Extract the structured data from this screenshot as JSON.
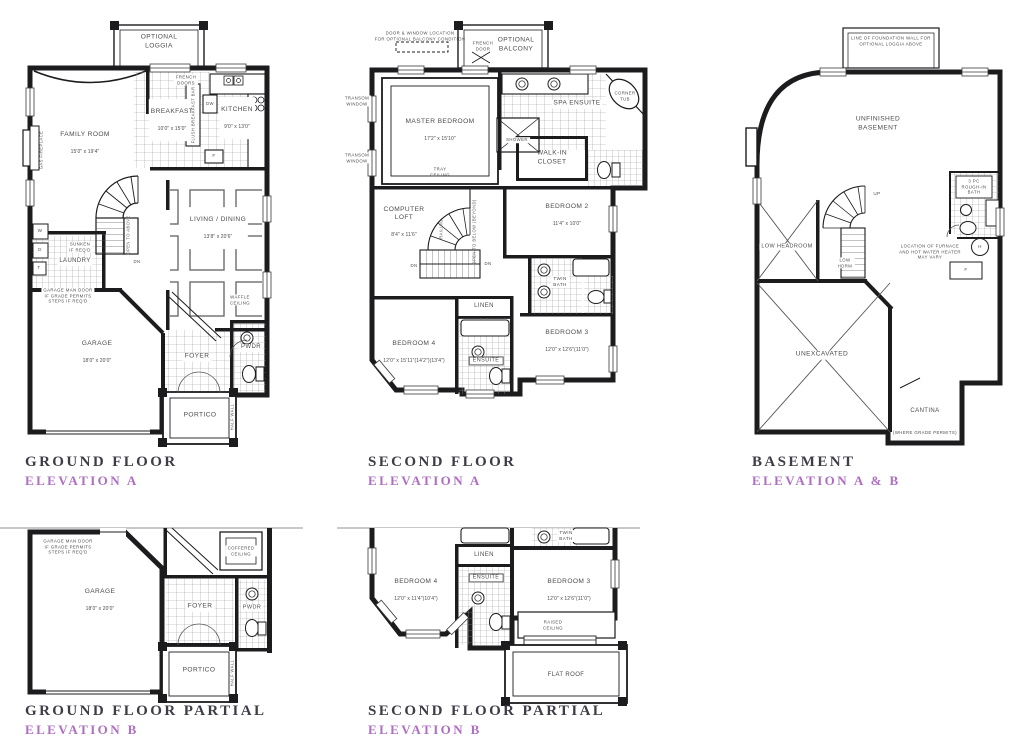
{
  "meta": {
    "sheet_background": "#ffffff",
    "wall_ink": "#1c1c1f",
    "label_gray": "#4c4c4e",
    "title_gray": "#3d3d47",
    "accent_purple": "#ae6fc3"
  },
  "ground_floor": {
    "title": "GROUND FLOOR",
    "elevation": "ELEVATION A",
    "loggia": "OPTIONAL\nLOGGIA",
    "french_doors": "FRENCH\nDOORS",
    "family_room": "FAMILY ROOM",
    "family_room_dims": "15'0\" x 19'4\"",
    "gas_fireplace": "GAS FIREPLACE",
    "breakfast": "BREAKFAST",
    "breakfast_dims": "10'0\" x 15'0\"",
    "kitchen": "KITCHEN",
    "kitchen_dims": "9'0\" x 13'0\"",
    "flush_breakfast_bar": "FLUSH BREAKFAST BAR",
    "dw": "DW",
    "fridge": "F",
    "living_dining": "LIVING / DINING",
    "living_dining_dims": "13'8\" x 20'6\"",
    "waffle_ceiling": "WAFFLE\nCEILING",
    "sunken": "SUNKEN\nIF REQ'D",
    "laundry": "LAUNDRY",
    "washer": "W",
    "dryer": "D",
    "tub": "T",
    "man_door_note": "GARAGE MAN DOOR\nIF GRADE PERMITS\nSTEPS IF REQ'D",
    "open_to_above": "OPEN TO ABOVE",
    "dn": "DN",
    "garage": "GARAGE",
    "garage_dims": "18'0\" x 20'0\"",
    "foyer": "FOYER",
    "pwdr": "PWDR",
    "portico": "PORTICO",
    "half_wall": "HALF WALL"
  },
  "second_floor": {
    "title": "SECOND FLOOR",
    "elevation": "ELEVATION A",
    "balcony_note": "DOOR & WINDOW LOCATION\nFOR OPTIONAL BALCONY CONDITION",
    "optional_balcony": "OPTIONAL\nBALCONY",
    "french_door": "FRENCH\nDOOR",
    "transom_window": "TRANSOM\nWINDOW",
    "master_bedroom": "MASTER BEDROOM",
    "master_bedroom_dims": "17'2\" x 15'10\"",
    "tray_ceiling": "TRAY\nCEILING",
    "spa_ensuite": "SPA ENSUITE",
    "corner_tub": "CORNER\nTUB",
    "shower": "SHOWER",
    "walk_in_closet": "WALK-IN\nCLOSET",
    "computer_loft": "COMPUTER\nLOFT",
    "computer_loft_dims": "8'4\" x 11'6\"",
    "railing": "RAILING",
    "open_to_below": "OPEN TO BELOW (BEYOND)",
    "dn": "DN",
    "bedroom2": "BEDROOM 2",
    "bedroom2_dims": "11'4\" x 10'0\"",
    "twin_bath": "TWIN\nBATH",
    "linen": "LINEN",
    "ensuite": "ENSUITE",
    "bedroom4": "BEDROOM 4",
    "bedroom4_dims": "12'0\" x 15'11\"(14'2\")(13'4\")",
    "bedroom3": "BEDROOM 3",
    "bedroom3_dims": "12'0\" x 12'6\"(11'0\")"
  },
  "basement": {
    "title": "BASEMENT",
    "elevation": "ELEVATION A & B",
    "foundation_note": "LINE OF FOUNDATION WALL FOR\nOPTIONAL LOGGIA ABOVE",
    "unfinished": "UNFINISHED\nBASEMENT",
    "up": "UP",
    "rough_in_bath": "3 PC\nROUGH-IN\nBATH",
    "furnace_note": "LOCATION OF FURNACE\nAND HOT WATER HEATER\nMAY VARY",
    "heater": "H",
    "furnace": "F",
    "low_headroom": "LOW HEADROOM",
    "low_hdrm": "LOW\nHDRM",
    "unexcavated": "UNEXCAVATED",
    "cantina": "CANTINA",
    "where_grade_permits": "(WHERE GRADE PERMITS)"
  },
  "ground_partial": {
    "title": "GROUND FLOOR PARTIAL",
    "elevation": "ELEVATION B",
    "man_door_note": "GARAGE MAN DOOR\nIF GRADE PERMITS\nSTEPS IF REQ'D",
    "garage": "GARAGE",
    "garage_dims": "18'0\" x 20'0\"",
    "coffered_ceiling": "COFFERED\nCEILING",
    "foyer": "FOYER",
    "pwdr": "PWDR",
    "portico": "PORTICO",
    "half_wall": "HALF WALL"
  },
  "second_partial": {
    "title": "SECOND FLOOR PARTIAL",
    "elevation": "ELEVATION B",
    "twin_bath": "TWIN\nBATH",
    "linen": "LINEN",
    "ensuite": "ENSUITE",
    "bedroom4": "BEDROOM 4",
    "bedroom4_dims": "12'0\" x 11'4\"(10'4\")",
    "bedroom3": "BEDROOM 3",
    "bedroom3_dims": "12'0\" x 12'6\"(11'0\")",
    "raised_ceiling": "RAISED\nCEILING",
    "flat_roof": "FLAT ROOF"
  }
}
